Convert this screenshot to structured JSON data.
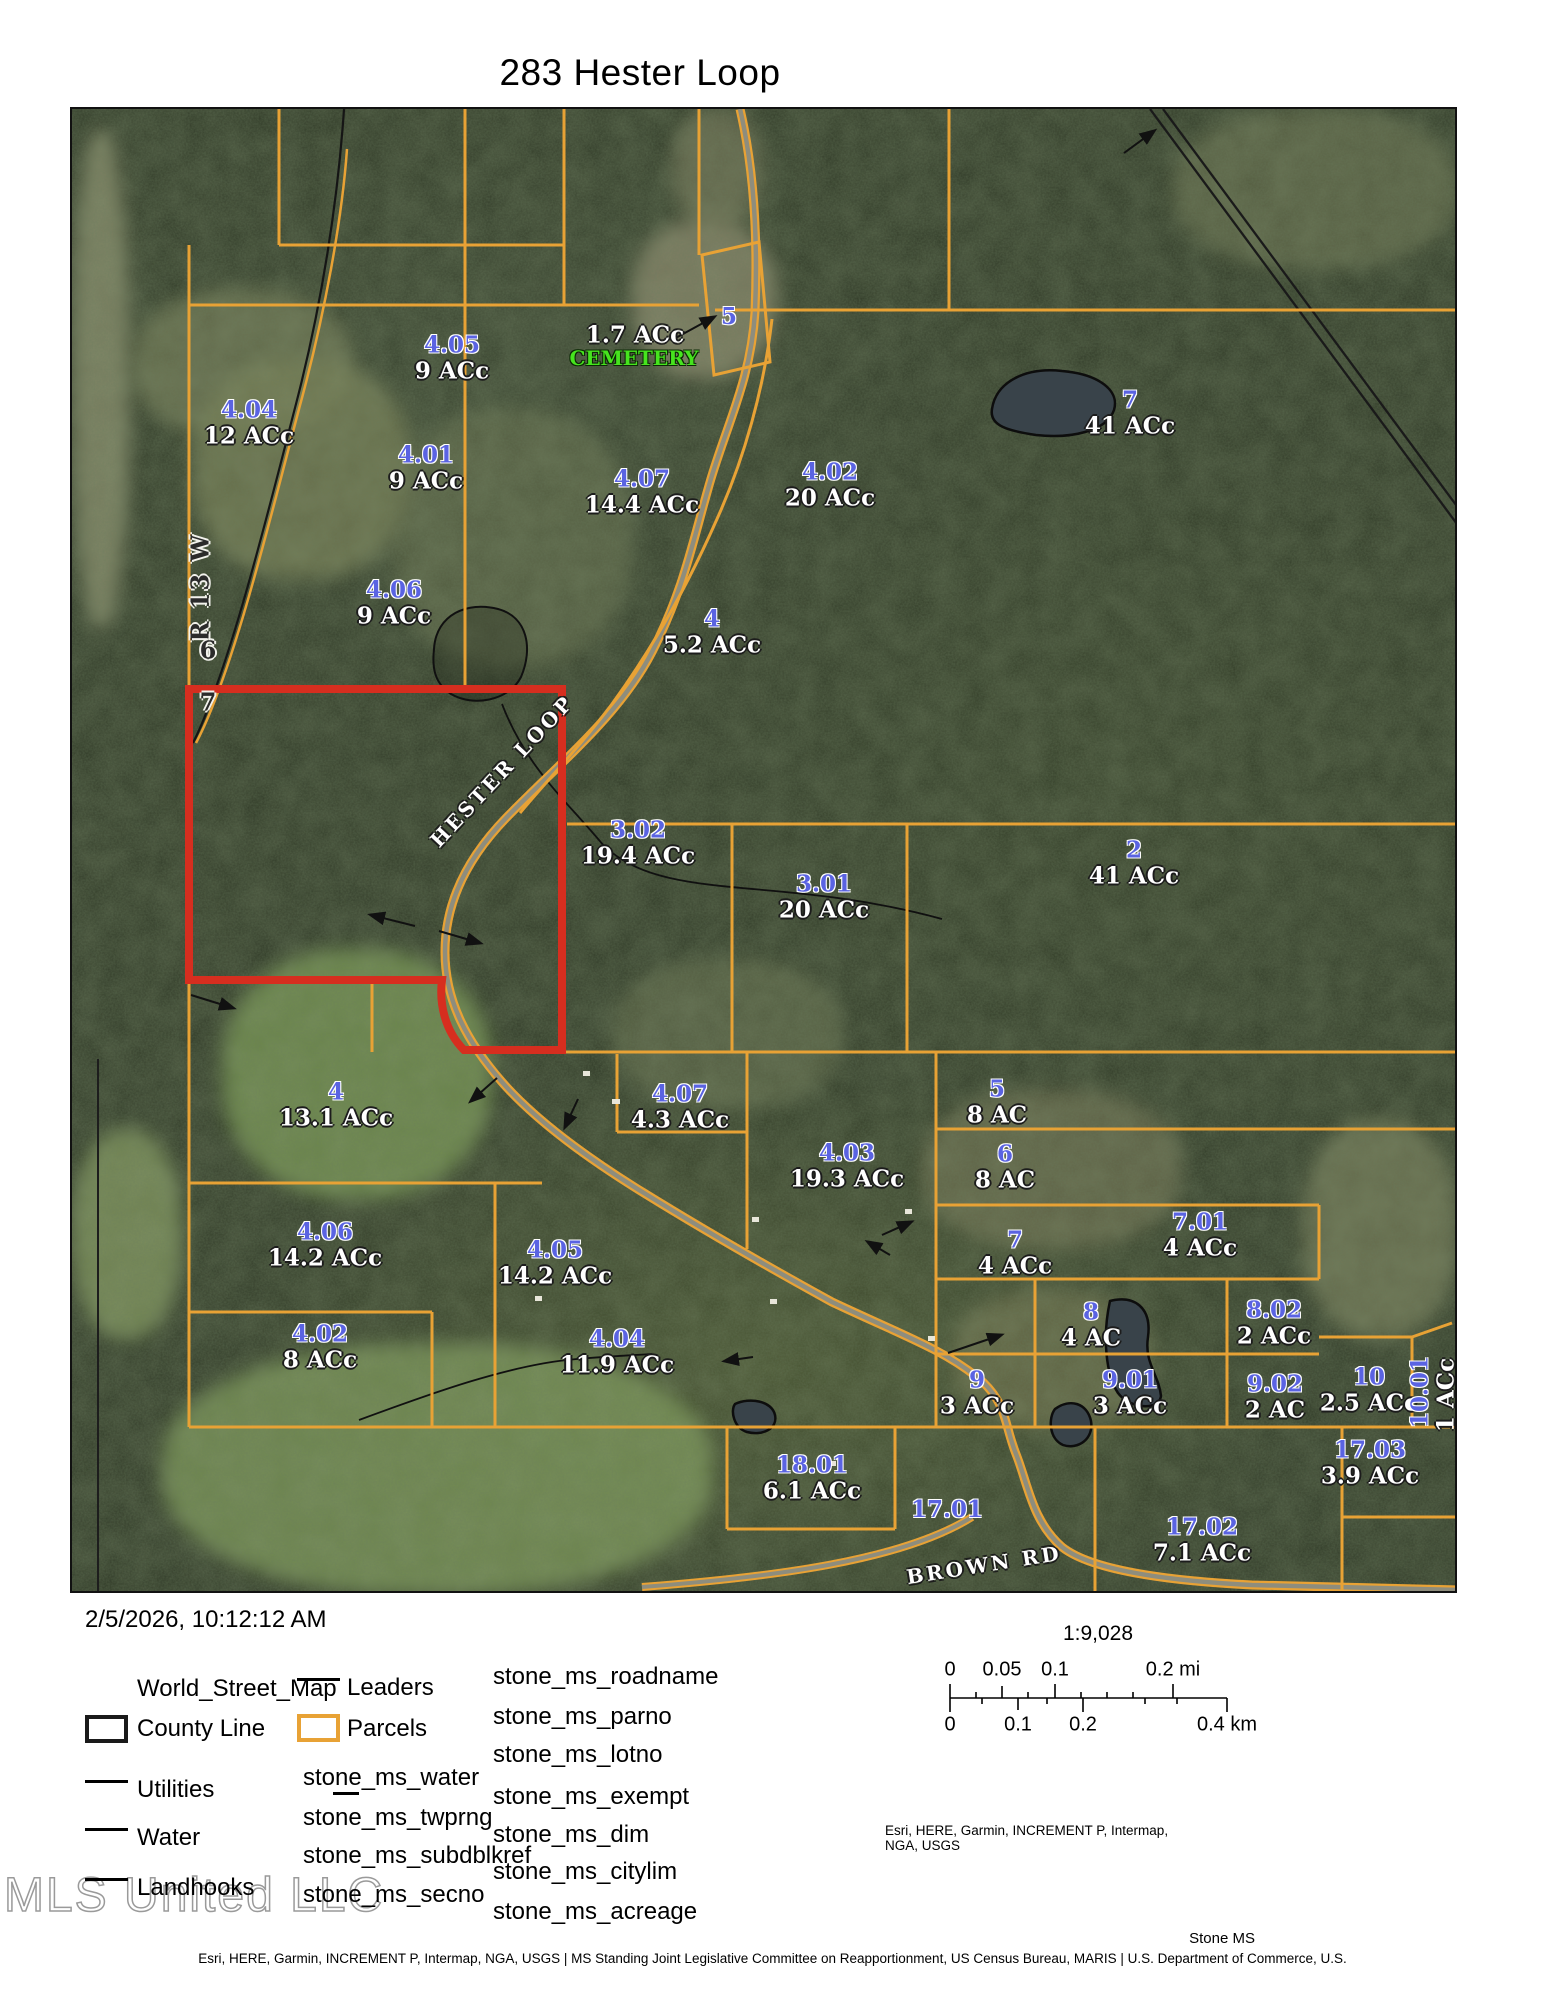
{
  "title": "283 Hester Loop",
  "timestamp": "2/5/2026, 10:12:12 AM",
  "colors": {
    "parcel_line": "#E8A235",
    "selection_red": "#D62E1F",
    "parcel_number_blue": "#5A63E2",
    "cemetery_green": "#46E41E",
    "road_fill": "#8E8D7D"
  },
  "scale": {
    "ratio_label": "1:9,028",
    "mi_labels": [
      {
        "t": "0",
        "x": 70
      },
      {
        "t": "0.05",
        "x": 122
      },
      {
        "t": "0.1",
        "x": 175
      },
      {
        "t": "0.2 mi",
        "x": 293
      }
    ],
    "km_labels": [
      {
        "t": "0",
        "x": 70
      },
      {
        "t": "0.1",
        "x": 138
      },
      {
        "t": "0.2",
        "x": 203
      },
      {
        "t": "0.4 km",
        "x": 347
      }
    ]
  },
  "attribution": {
    "map_credit": "Esri, HERE, Garmin, INCREMENT P, Intermap, NGA, USGS",
    "corner": "Stone MS",
    "footer": "Esri, HERE, Garmin, INCREMENT P, Intermap, NGA, USGS | MS Standing Joint Legislative Committee on Reapportionment, US Census Bureau, MARIS | U.S. Department of Commerce, U.S.",
    "watermark": "MLS United LLC"
  },
  "legend": {
    "col1": [
      {
        "label": "World_Street_Map",
        "swatch": "none",
        "y": 1689
      },
      {
        "label": "County Line",
        "swatch": "rect-black",
        "y": 1729
      },
      {
        "label": "Utilities",
        "swatch": "line",
        "y": 1790
      },
      {
        "label": "Water",
        "swatch": "line",
        "y": 1838
      },
      {
        "label": "Landhooks",
        "swatch": "line",
        "y": 1888
      }
    ],
    "col2": [
      {
        "label": "Leaders",
        "swatch": "line",
        "y": 1688
      },
      {
        "label": "Parcels",
        "swatch": "rect-orange",
        "y": 1729
      },
      {
        "label": "stone_ms_water",
        "swatch": "underline",
        "y": 1778
      },
      {
        "label": "stone_ms_twprng",
        "swatch": "none",
        "y": 1818
      },
      {
        "label": "stone_ms_subdblkref",
        "swatch": "none",
        "y": 1856
      },
      {
        "label": "stone_ms_secno",
        "swatch": "none",
        "y": 1895
      }
    ],
    "col3": [
      {
        "label": "stone_ms_roadname",
        "y": 1677
      },
      {
        "label": "stone_ms_parno",
        "y": 1717
      },
      {
        "label": "stone_ms_lotno",
        "y": 1755
      },
      {
        "label": "stone_ms_exempt",
        "y": 1797
      },
      {
        "label": "stone_ms_dim",
        "y": 1835
      },
      {
        "label": "stone_ms_citylim",
        "y": 1872
      },
      {
        "label": "stone_ms_acreage",
        "y": 1912
      }
    ]
  },
  "map": {
    "parcel_labels": [
      {
        "no": "4.05",
        "ac": "9 ACc",
        "x": 380,
        "y": 236
      },
      {
        "no": "4.04",
        "ac": "12 ACc",
        "x": 177,
        "y": 301
      },
      {
        "no": "4.01",
        "ac": "9 ACc",
        "x": 354,
        "y": 346
      },
      {
        "no": "5",
        "ac": "",
        "x": 657,
        "y": 208
      },
      {
        "no": "4.07",
        "ac": "14.4 ACc",
        "x": 570,
        "y": 370
      },
      {
        "no": "4.02",
        "ac": "20 ACc",
        "x": 758,
        "y": 363
      },
      {
        "no": "7",
        "ac": "41 ACc",
        "x": 1058,
        "y": 291
      },
      {
        "no": "4.06",
        "ac": "9 ACc",
        "x": 322,
        "y": 481
      },
      {
        "no": "4",
        "ac": "5.2 ACc",
        "x": 640,
        "y": 510
      },
      {
        "no": "3.02",
        "ac": "19.4 ACc",
        "x": 566,
        "y": 721
      },
      {
        "no": "3.01",
        "ac": "20 ACc",
        "x": 752,
        "y": 775
      },
      {
        "no": "2",
        "ac": "41 ACc",
        "x": 1062,
        "y": 741
      },
      {
        "no": "4",
        "ac": "13.1 ACc",
        "x": 264,
        "y": 983
      },
      {
        "no": "4.07",
        "ac": "4.3 ACc",
        "x": 608,
        "y": 985
      },
      {
        "no": "4.03",
        "ac": "19.3 ACc",
        "x": 775,
        "y": 1044
      },
      {
        "no": "5",
        "ac": "8 AC",
        "x": 925,
        "y": 980
      },
      {
        "no": "6",
        "ac": "8 AC",
        "x": 933,
        "y": 1045
      },
      {
        "no": "7",
        "ac": "4 ACc",
        "x": 943,
        "y": 1131
      },
      {
        "no": "7.01",
        "ac": "4 ACc",
        "x": 1128,
        "y": 1113
      },
      {
        "no": "8",
        "ac": "4 AC",
        "x": 1019,
        "y": 1203
      },
      {
        "no": "8.02",
        "ac": "2 ACc",
        "x": 1202,
        "y": 1201
      },
      {
        "no": "9",
        "ac": "3 ACc",
        "x": 905,
        "y": 1271
      },
      {
        "no": "9.01",
        "ac": "3 ACc",
        "x": 1058,
        "y": 1271
      },
      {
        "no": "9.02",
        "ac": "2 AC",
        "x": 1203,
        "y": 1275
      },
      {
        "no": "10",
        "ac": "2.5 ACc",
        "x": 1297,
        "y": 1268
      },
      {
        "no": "4.06",
        "ac": "14.2 ACc",
        "x": 253,
        "y": 1123
      },
      {
        "no": "4.05",
        "ac": "14.2 ACc",
        "x": 483,
        "y": 1141
      },
      {
        "no": "4.04",
        "ac": "11.9 ACc",
        "x": 545,
        "y": 1230
      },
      {
        "no": "4.02",
        "ac": "8 ACc",
        "x": 248,
        "y": 1225
      },
      {
        "no": "18.01",
        "ac": "6.1 ACc",
        "x": 740,
        "y": 1356
      },
      {
        "no": "17.01",
        "ac": "",
        "x": 875,
        "y": 1401
      },
      {
        "no": "17.02",
        "ac": "7.1 ACc",
        "x": 1130,
        "y": 1418
      },
      {
        "no": "17.03",
        "ac": "3.9 ACc",
        "x": 1298,
        "y": 1341
      }
    ],
    "text_labels": [
      {
        "text": "1.7 ACc",
        "cls": "ac",
        "x": 563,
        "y": 226,
        "rot": 0
      },
      {
        "text": "CEMETERY",
        "cls": "cem",
        "x": 562,
        "y": 249,
        "rot": 0
      },
      {
        "text": "HESTER LOOP",
        "cls": "road",
        "x": 430,
        "y": 662,
        "rot": -47
      },
      {
        "text": "BROWN RD",
        "cls": "road",
        "x": 912,
        "y": 1456,
        "rot": -9
      },
      {
        "text": "R 13 W",
        "cls": "twp",
        "x": 128,
        "y": 478,
        "rot": -90
      },
      {
        "text": "6",
        "cls": "twp",
        "x": 137,
        "y": 541,
        "rot": 0
      },
      {
        "text": "7",
        "cls": "twp",
        "x": 137,
        "y": 593,
        "rot": 0
      },
      {
        "text": "10.01",
        "cls": "pno-v",
        "x": 1348,
        "y": 1283,
        "rot": -90
      },
      {
        "text": "1 ACc",
        "cls": "ac",
        "x": 1374,
        "y": 1286,
        "rot": -90
      }
    ]
  }
}
